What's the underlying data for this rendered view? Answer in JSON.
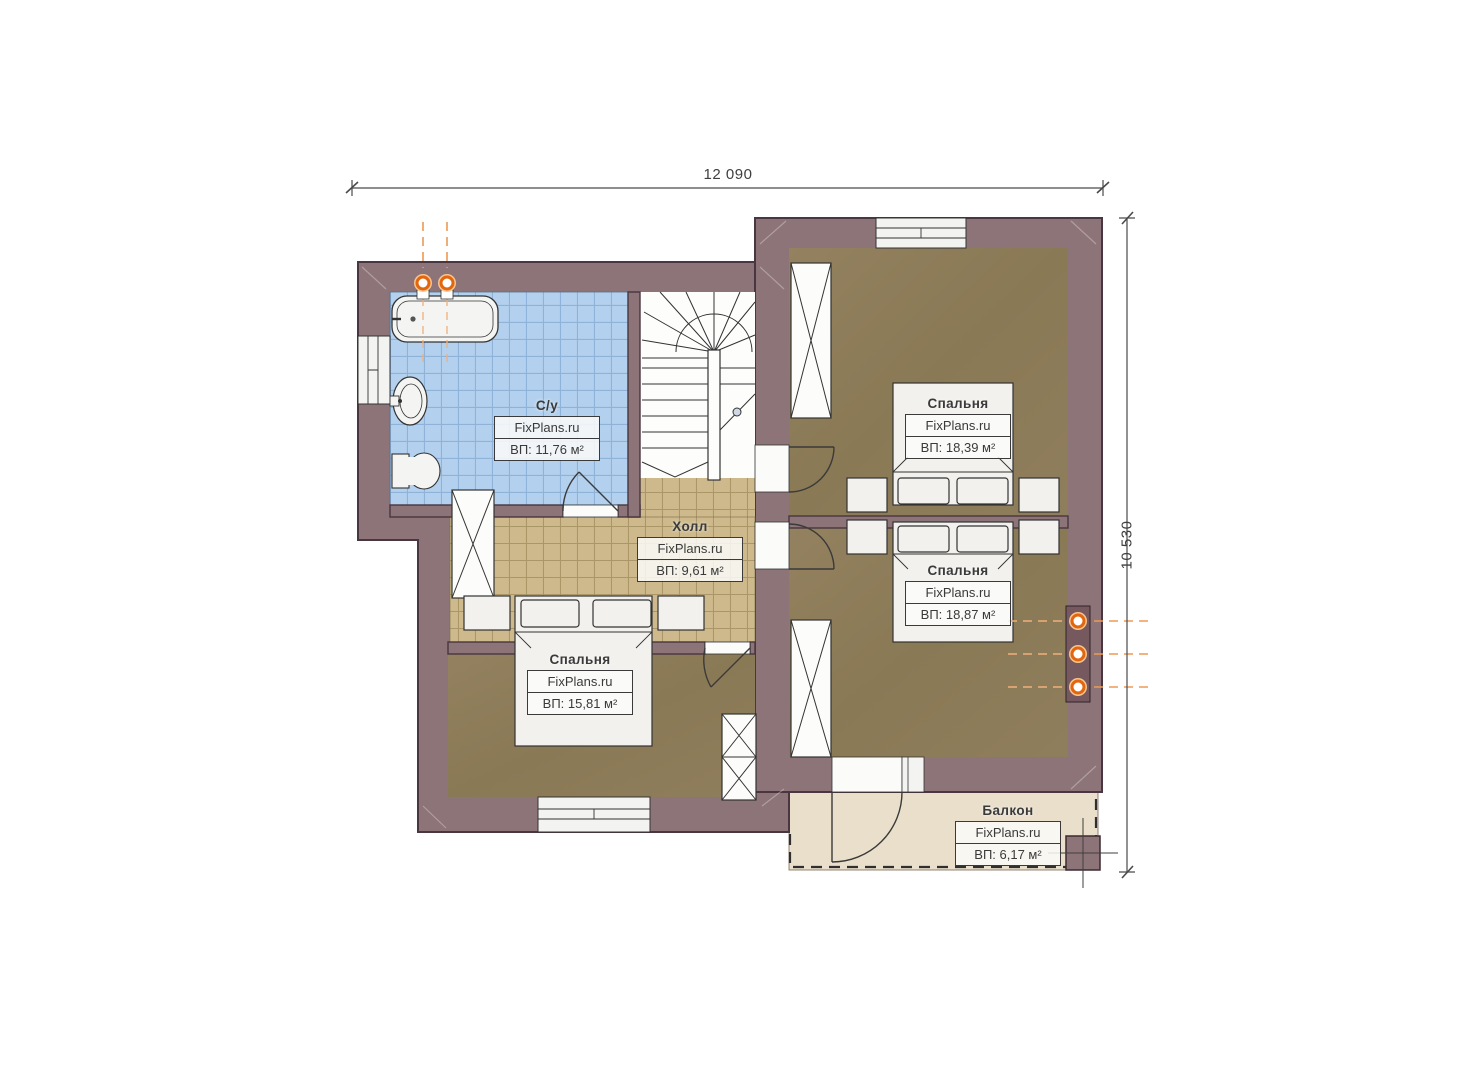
{
  "plan": {
    "brand": "FixPlans.ru",
    "dimensions": {
      "width": "12 090",
      "height": "10 530"
    },
    "rooms": [
      {
        "key": "bathroom",
        "name": "С/у",
        "brand": "FixPlans.ru",
        "area": "ВП: 11,76 м²"
      },
      {
        "key": "hall",
        "name": "Холл",
        "brand": "FixPlans.ru",
        "area": "ВП: 9,61 м²"
      },
      {
        "key": "bedroom-top-right",
        "name": "Спальня",
        "brand": "FixPlans.ru",
        "area": "ВП: 18,39 м²"
      },
      {
        "key": "bedroom-right",
        "name": "Спальня",
        "brand": "FixPlans.ru",
        "area": "ВП: 18,87 м²"
      },
      {
        "key": "bedroom-left",
        "name": "Спальня",
        "brand": "FixPlans.ru",
        "area": "ВП: 15,81 м²"
      },
      {
        "key": "balcony",
        "name": "Балкон",
        "brand": "FixPlans.ru",
        "area": "ВП: 6,17 м²"
      }
    ],
    "colors": {
      "wall": "#8d7478",
      "wall_outline": "#493640",
      "bedroom_floor": "#8e7d5b",
      "hall_floor": "#cdb98c",
      "bath_floor": "#b3d1ee",
      "balcony_floor": "#e9dfca",
      "accent_orange": "#e2660f"
    }
  }
}
